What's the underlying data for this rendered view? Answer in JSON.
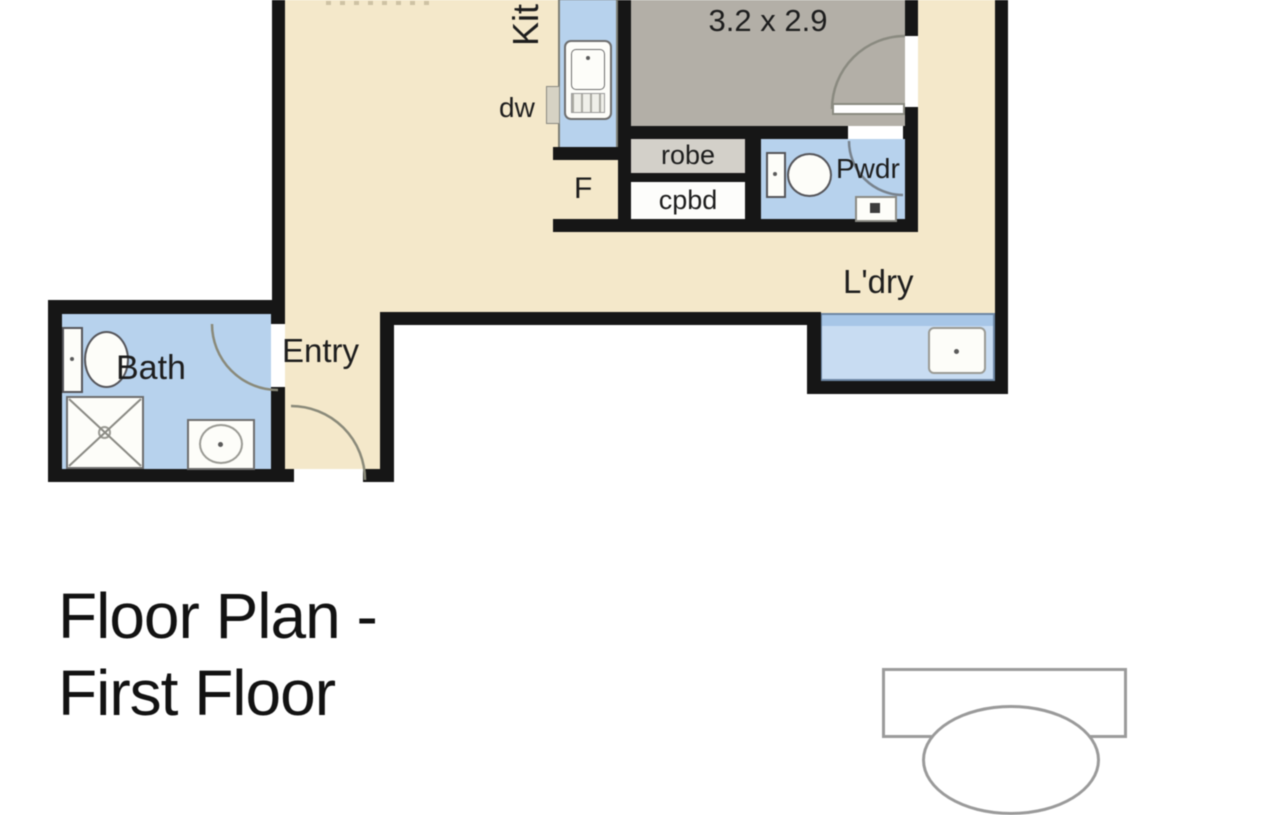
{
  "plan": {
    "labels": {
      "kitchen": "Kit",
      "dishwasher": "dw",
      "fridge": "F",
      "bedroom_dimensions": "3.2 x 2.9",
      "robe": "robe",
      "cupboard": "cpbd",
      "powder": "Pwdr",
      "laundry": "L'dry",
      "entry": "Entry",
      "bath": "Bath"
    }
  },
  "caption": {
    "line1": "Floor Plan -",
    "line2": "First Floor"
  },
  "colors": {
    "floor_beige": "#f4e8ca",
    "floor_blue": "#b7d2ed",
    "floor_gray": "#b3afa7",
    "robe_gray": "#d3d0c9",
    "wall": "#161616",
    "fixture_border": "#6e6e6e",
    "door_arc": "#8a8a7e",
    "text": "#1d1d1d"
  }
}
